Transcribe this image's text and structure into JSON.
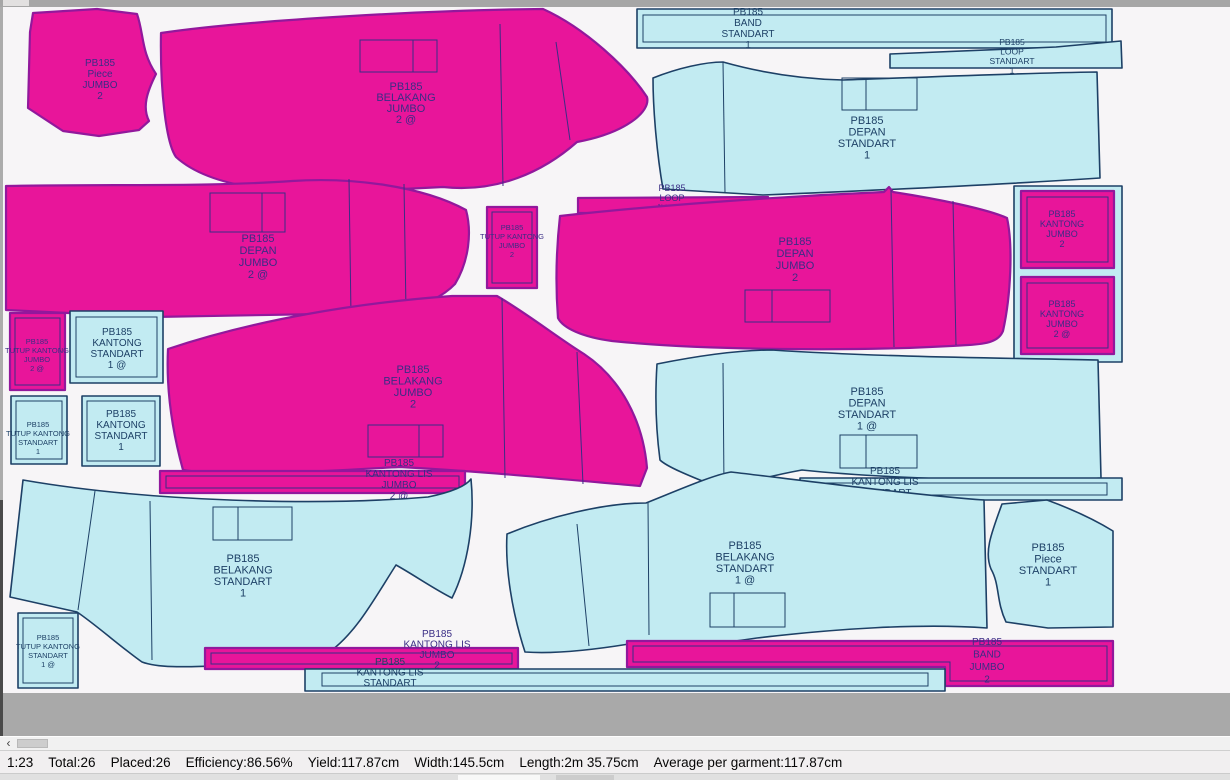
{
  "colors": {
    "pink-fill": "#E8159A",
    "pink-stroke": "#92189C",
    "pink-text": "#3A2D85",
    "cyan-fill": "#C2EBF2",
    "cyan-stroke": "#1D4066",
    "cyan-text": "#1D4066",
    "canvas-bg": "#F7F5F7",
    "outside-grey": "#A9A9A9",
    "chrome-grey": "#A6A6A6"
  },
  "icons": {
    "scroll-left-arrow": "‹"
  },
  "status_bar": {
    "scale": "1:23",
    "total": "Total:26",
    "placed": "Placed:26",
    "efficiency": "Efficiency:86.56%",
    "yield": "Yield:117.87cm",
    "width": "Width:145.5cm",
    "length": "Length:2m 35.75cm",
    "average": "Average per garment:117.87cm"
  },
  "pieces": [
    {
      "name": "piece-jumbo-2",
      "lines": [
        "PB185",
        "Piece",
        "JUMBO",
        "2"
      ]
    },
    {
      "name": "belakang-jumbo-2a",
      "lines": [
        "PB185",
        "BELAKANG",
        "JUMBO",
        "2 @"
      ]
    },
    {
      "name": "band-standart-1",
      "lines": [
        "PB185",
        "BAND",
        "STANDART",
        "1"
      ]
    },
    {
      "name": "loop-standart-1",
      "lines": [
        "PB185",
        "LOOP",
        "STANDART",
        "1"
      ]
    },
    {
      "name": "depan-standart-1",
      "lines": [
        "PB185",
        "DEPAN",
        "STANDART",
        "1"
      ]
    },
    {
      "name": "depan-jumbo-2a",
      "lines": [
        "PB185",
        "DEPAN",
        "JUMBO",
        "2 @"
      ]
    },
    {
      "name": "loop-jumbo-2",
      "lines": [
        "PB185",
        "LOOP",
        "JUMBO",
        "2"
      ]
    },
    {
      "name": "tutup-kantong-jumbo-2",
      "lines": [
        "PB185",
        "TUTUP KANTONG",
        "JUMBO",
        "2"
      ]
    },
    {
      "name": "depan-jumbo-2",
      "lines": [
        "PB185",
        "DEPAN",
        "JUMBO",
        "2"
      ]
    },
    {
      "name": "kantong-jumbo-2",
      "lines": [
        "PB185",
        "KANTONG",
        "JUMBO",
        "2"
      ]
    },
    {
      "name": "kantong-jumbo-2a",
      "lines": [
        "PB185",
        "KANTONG",
        "JUMBO",
        "2 @"
      ]
    },
    {
      "name": "tutup-kantong-jumbo-2a",
      "lines": [
        "PB185",
        "TUTUP KANTONG",
        "JUMBO",
        "2 @"
      ]
    },
    {
      "name": "kantong-standart-1a",
      "lines": [
        "PB185",
        "KANTONG",
        "STANDART",
        "1 @"
      ]
    },
    {
      "name": "tutup-kantong-standart-1",
      "lines": [
        "PB185",
        "TUTUP KANTONG",
        "STANDART",
        "1"
      ]
    },
    {
      "name": "kantong-standart-1",
      "lines": [
        "PB185",
        "KANTONG",
        "STANDART",
        "1"
      ]
    },
    {
      "name": "belakang-jumbo-2",
      "lines": [
        "PB185",
        "BELAKANG",
        "JUMBO",
        "2"
      ]
    },
    {
      "name": "kantong-lis-jumbo-2a",
      "lines": [
        "PB185",
        "KANTONG LIS",
        "JUMBO",
        "2 @"
      ]
    },
    {
      "name": "depan-standart-1a",
      "lines": [
        "PB185",
        "DEPAN",
        "STANDART",
        "1 @"
      ]
    },
    {
      "name": "kantong-lis-standart-1a",
      "lines": [
        "PB185",
        "KANTONG LIS",
        "STANDART",
        "1 @"
      ]
    },
    {
      "name": "belakang-standart-1",
      "lines": [
        "PB185",
        "BELAKANG",
        "STANDART",
        "1"
      ]
    },
    {
      "name": "tutup-kantong-standart-1a",
      "lines": [
        "PB185",
        "TUTUP KANTONG",
        "STANDART",
        "1 @"
      ]
    },
    {
      "name": "belakang-standart-1a",
      "lines": [
        "PB185",
        "BELAKANG",
        "STANDART",
        "1 @"
      ]
    },
    {
      "name": "piece-standart-1",
      "lines": [
        "PB185",
        "Piece",
        "STANDART",
        "1"
      ]
    },
    {
      "name": "kantong-lis-jumbo-2",
      "lines": [
        "PB185",
        "KANTONG LIS",
        "JUMBO",
        "2"
      ]
    },
    {
      "name": "kantong-lis-standart",
      "lines": [
        "PB185",
        "KANTONG LIS",
        "STANDART"
      ]
    },
    {
      "name": "band-jumbo-2",
      "lines": [
        "PB185",
        "BAND",
        "JUMBO",
        "2"
      ]
    }
  ]
}
